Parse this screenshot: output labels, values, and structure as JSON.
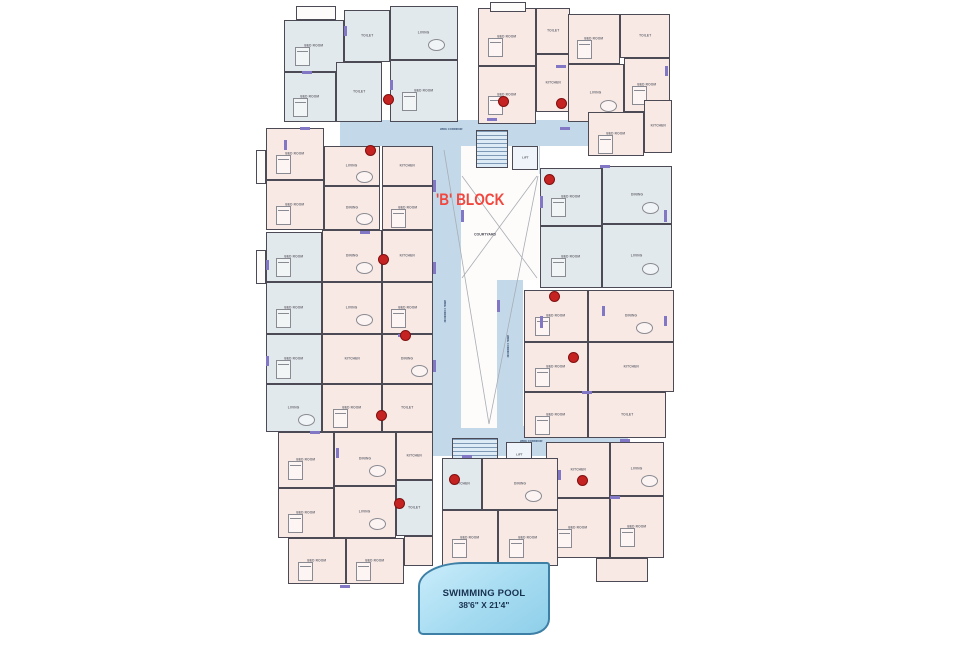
{
  "title": {
    "text": "'B' BLOCK",
    "color": "#f2473f"
  },
  "courtyard_label": "COURTYARD",
  "corridor_label": "WIDE CORRIDOR",
  "lift_label": "LIFT",
  "pool": {
    "name": "SWIMMING POOL",
    "dimensions": "38'6\" X 21'4\"",
    "fill": "#a5dbf1",
    "border": "#3e7fa6"
  },
  "palette": {
    "wall": "#4c4a54",
    "P": "#f8e9e4",
    "B": "#e2e9ec",
    "W": "#fdfcfb",
    "corridor": "#c3d9ea",
    "dot": "#c52222",
    "tick": "#8277c4",
    "line": "#a9adb4"
  },
  "plan": {
    "corridors": [
      [
        340,
        120,
        300,
        26
      ],
      [
        433,
        146,
        28,
        290
      ],
      [
        497,
        280,
        26,
        150
      ],
      [
        433,
        426,
        195,
        30
      ],
      [
        472,
        146,
        68,
        28
      ]
    ],
    "courtyards": [
      [
        461,
        146,
        78,
        134
      ],
      [
        461,
        280,
        36,
        148
      ]
    ],
    "stairs": [
      [
        476,
        130,
        32,
        38
      ],
      [
        452,
        438,
        46,
        32
      ]
    ],
    "lifts": [
      [
        512,
        146,
        26,
        24
      ],
      [
        506,
        442,
        26,
        26
      ]
    ],
    "rooms": [
      [
        284,
        20,
        60,
        52,
        "B",
        "BED ROOM"
      ],
      [
        284,
        72,
        52,
        50,
        "B",
        "BED ROOM"
      ],
      [
        336,
        62,
        46,
        60,
        "B",
        "TOILET"
      ],
      [
        344,
        10,
        46,
        52,
        "B",
        "TOILET"
      ],
      [
        390,
        6,
        68,
        54,
        "B",
        "LIVING"
      ],
      [
        390,
        60,
        68,
        62,
        "B",
        "BED ROOM"
      ],
      [
        296,
        6,
        40,
        14,
        "W",
        ""
      ],
      [
        478,
        8,
        58,
        58,
        "P",
        "BED ROOM"
      ],
      [
        536,
        8,
        34,
        46,
        "P",
        "TOILET"
      ],
      [
        478,
        66,
        58,
        58,
        "P",
        "BED ROOM"
      ],
      [
        536,
        54,
        34,
        58,
        "P",
        "KITCHEN"
      ],
      [
        490,
        2,
        36,
        10,
        "W",
        ""
      ],
      [
        568,
        14,
        52,
        50,
        "P",
        "BED ROOM"
      ],
      [
        620,
        14,
        50,
        44,
        "P",
        "TOILET"
      ],
      [
        568,
        64,
        56,
        58,
        "P",
        "LIVING"
      ],
      [
        624,
        58,
        46,
        54,
        "P",
        "BED ROOM"
      ],
      [
        588,
        112,
        56,
        44,
        "P",
        "BED ROOM"
      ],
      [
        644,
        100,
        28,
        53,
        "P",
        "KITCHEN"
      ],
      [
        540,
        168,
        62,
        58,
        "B",
        "BED ROOM"
      ],
      [
        540,
        226,
        62,
        62,
        "B",
        "BED ROOM"
      ],
      [
        602,
        166,
        70,
        58,
        "B",
        "DINING"
      ],
      [
        602,
        224,
        70,
        64,
        "B",
        "LIVING"
      ],
      [
        524,
        290,
        64,
        52,
        "P",
        "BED ROOM"
      ],
      [
        524,
        342,
        64,
        50,
        "P",
        "BED ROOM"
      ],
      [
        588,
        290,
        86,
        52,
        "P",
        "DINING"
      ],
      [
        588,
        342,
        86,
        50,
        "P",
        "KITCHEN"
      ],
      [
        524,
        392,
        64,
        46,
        "P",
        "BED ROOM"
      ],
      [
        588,
        392,
        78,
        46,
        "P",
        "TOILET"
      ],
      [
        546,
        442,
        64,
        56,
        "P",
        "KITCHEN"
      ],
      [
        610,
        442,
        54,
        54,
        "P",
        "LIVING"
      ],
      [
        546,
        498,
        64,
        60,
        "P",
        "BED ROOM"
      ],
      [
        610,
        496,
        54,
        62,
        "P",
        "BED ROOM"
      ],
      [
        596,
        558,
        52,
        24,
        "P",
        ""
      ],
      [
        442,
        458,
        40,
        52,
        "B",
        "KITCHEN"
      ],
      [
        482,
        458,
        76,
        52,
        "P",
        "DINING"
      ],
      [
        442,
        510,
        56,
        56,
        "P",
        "BED ROOM"
      ],
      [
        498,
        510,
        60,
        56,
        "P",
        "BED ROOM"
      ],
      [
        266,
        128,
        58,
        52,
        "P",
        "BED ROOM"
      ],
      [
        266,
        180,
        58,
        50,
        "P",
        "BED ROOM"
      ],
      [
        324,
        146,
        56,
        40,
        "P",
        "LIVING"
      ],
      [
        324,
        186,
        56,
        44,
        "P",
        "DINING"
      ],
      [
        382,
        146,
        51,
        40,
        "P",
        "KITCHEN"
      ],
      [
        382,
        186,
        51,
        44,
        "P",
        "BED ROOM"
      ],
      [
        256,
        150,
        10,
        34,
        "W",
        ""
      ],
      [
        266,
        232,
        56,
        50,
        "B",
        "BED ROOM"
      ],
      [
        266,
        282,
        56,
        52,
        "B",
        "BED ROOM"
      ],
      [
        322,
        230,
        60,
        52,
        "P",
        "DINING"
      ],
      [
        322,
        282,
        60,
        52,
        "P",
        "LIVING"
      ],
      [
        382,
        230,
        51,
        52,
        "P",
        "KITCHEN"
      ],
      [
        382,
        282,
        51,
        52,
        "P",
        "BED ROOM"
      ],
      [
        256,
        250,
        10,
        34,
        "W",
        ""
      ],
      [
        266,
        334,
        56,
        50,
        "B",
        "BED ROOM"
      ],
      [
        266,
        384,
        56,
        48,
        "B",
        "LIVING"
      ],
      [
        322,
        334,
        60,
        50,
        "P",
        "KITCHEN"
      ],
      [
        322,
        384,
        60,
        48,
        "P",
        "BED ROOM"
      ],
      [
        382,
        334,
        51,
        50,
        "P",
        "DINING"
      ],
      [
        382,
        384,
        51,
        48,
        "P",
        "TOILET"
      ],
      [
        278,
        432,
        56,
        56,
        "P",
        "BED ROOM"
      ],
      [
        278,
        488,
        56,
        50,
        "P",
        "BED ROOM"
      ],
      [
        334,
        432,
        62,
        54,
        "P",
        "DINING"
      ],
      [
        334,
        486,
        62,
        52,
        "P",
        "LIVING"
      ],
      [
        396,
        432,
        37,
        48,
        "P",
        "KITCHEN"
      ],
      [
        396,
        480,
        37,
        56,
        "B",
        "TOILET"
      ],
      [
        288,
        538,
        58,
        46,
        "P",
        "BED ROOM"
      ],
      [
        346,
        538,
        58,
        46,
        "P",
        "BED ROOM"
      ],
      [
        404,
        536,
        29,
        30,
        "P",
        ""
      ]
    ],
    "diagonals": [
      [
        462,
        176,
        537,
        278
      ],
      [
        537,
        176,
        462,
        278
      ],
      [
        444,
        150,
        489,
        424
      ],
      [
        538,
        176,
        489,
        424
      ]
    ],
    "dots": [
      [
        388,
        99
      ],
      [
        503,
        101
      ],
      [
        561,
        103
      ],
      [
        370,
        150
      ],
      [
        549,
        179
      ],
      [
        383,
        259
      ],
      [
        554,
        296
      ],
      [
        405,
        335
      ],
      [
        573,
        357
      ],
      [
        381,
        415
      ],
      [
        454,
        479
      ],
      [
        582,
        480
      ],
      [
        399,
        503
      ]
    ],
    "ticks": [
      [
        344,
        26,
        3,
        10
      ],
      [
        390,
        80,
        3,
        10
      ],
      [
        433,
        180,
        3,
        12
      ],
      [
        433,
        262,
        3,
        12
      ],
      [
        433,
        360,
        3,
        12
      ],
      [
        461,
        210,
        3,
        12
      ],
      [
        497,
        300,
        3,
        12
      ],
      [
        540,
        196,
        3,
        12
      ],
      [
        540,
        316,
        3,
        12
      ],
      [
        602,
        306,
        3,
        10
      ],
      [
        665,
        66,
        3,
        10
      ],
      [
        284,
        140,
        3,
        10
      ],
      [
        266,
        260,
        3,
        10
      ],
      [
        266,
        356,
        3,
        10
      ],
      [
        336,
        448,
        3,
        10
      ],
      [
        558,
        470,
        3,
        10
      ],
      [
        664,
        210,
        3,
        12
      ],
      [
        664,
        316,
        3,
        10
      ],
      [
        300,
        127,
        10,
        3
      ],
      [
        360,
        231,
        10,
        3
      ],
      [
        398,
        334,
        10,
        3
      ],
      [
        310,
        431,
        10,
        3
      ],
      [
        487,
        118,
        10,
        3
      ],
      [
        560,
        127,
        10,
        3
      ],
      [
        600,
        165,
        10,
        3
      ],
      [
        582,
        391,
        10,
        3
      ],
      [
        340,
        585,
        10,
        3
      ],
      [
        462,
        455,
        10,
        3
      ],
      [
        620,
        439,
        10,
        3
      ],
      [
        302,
        71,
        10,
        3
      ],
      [
        556,
        65,
        10,
        3
      ],
      [
        610,
        496,
        10,
        3
      ]
    ],
    "corridor_texts": [
      [
        440,
        128,
        0
      ],
      [
        446,
        300,
        90
      ],
      [
        509,
        335,
        90
      ],
      [
        520,
        440,
        0
      ]
    ]
  }
}
